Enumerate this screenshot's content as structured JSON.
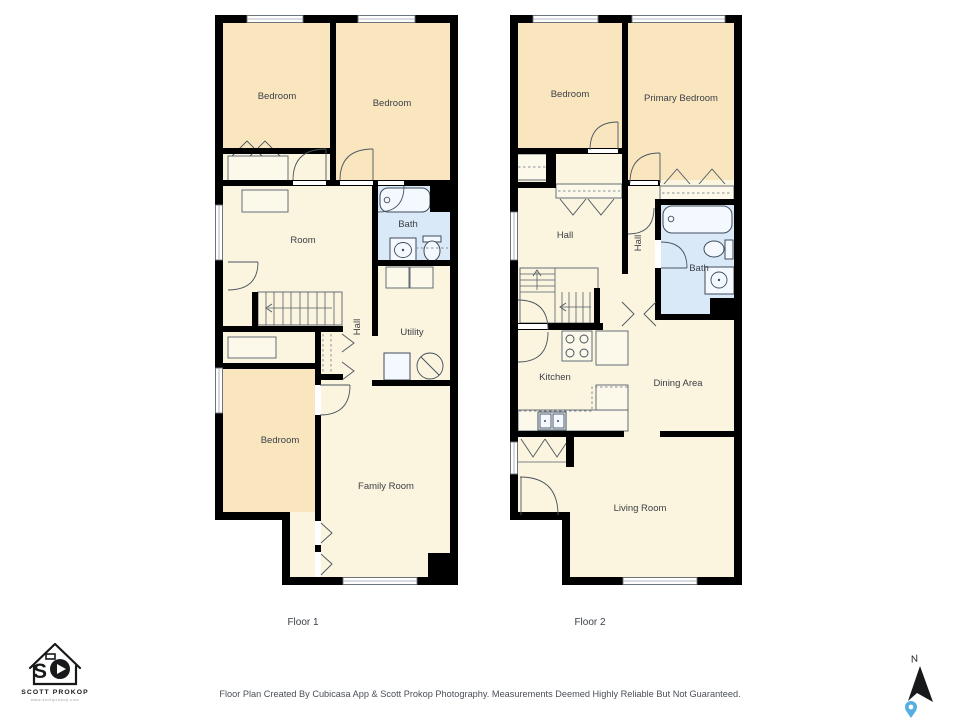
{
  "floor1": {
    "caption": "Floor 1",
    "rooms": {
      "bedroom_top_left": "Bedroom",
      "bedroom_top_right": "Bedroom",
      "room": "Room",
      "bath": "Bath",
      "hall": "Hall",
      "utility": "Utility",
      "bedroom_bottom": "Bedroom",
      "family_room": "Family Room"
    }
  },
  "floor2": {
    "caption": "Floor 2",
    "rooms": {
      "bedroom": "Bedroom",
      "primary_bedroom": "Primary Bedroom",
      "hall_upper": "Hall",
      "hall_corridor": "Hall",
      "bath": "Bath",
      "kitchen": "Kitchen",
      "dining_area": "Dining Area",
      "living_room": "Living Room"
    }
  },
  "footer": {
    "disclaimer": "Floor Plan Created By Cubicasa App & Scott Prokop Photography. Measurements Deemed Highly Reliable But Not Guaranteed."
  },
  "logo": {
    "initial": "S",
    "name": "SCOTT PROKOP",
    "website": "www.scottprokop.com"
  },
  "compass": {
    "north_label": "N"
  },
  "colors": {
    "bedroom_fill": "#f9e6bf",
    "room_fill": "#fbf4de",
    "bath_fill": "#d9e9f8",
    "wall": "#000000",
    "pin_blue": "#55aee2"
  }
}
